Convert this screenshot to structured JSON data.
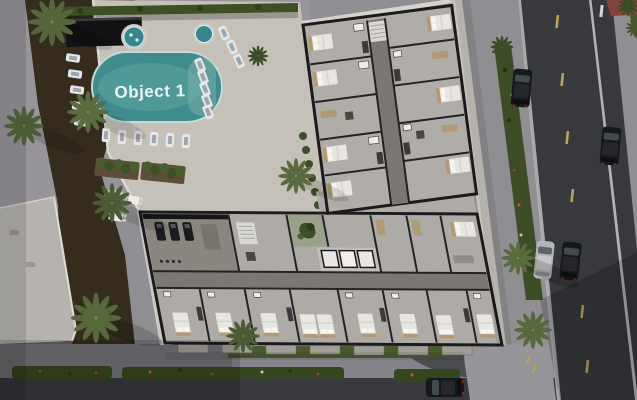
{
  "scene": {
    "title": "Aerial 3D cutaway render of a residential complex",
    "view": "top-down dollhouse view showing furnished apartment floor plans, rooftop pool amenity deck, palm landscaping and surrounding streets"
  },
  "pool": {
    "brand_label": "Object 1",
    "water_color": "#3f8b8e",
    "label_color": "#e9f5f3"
  },
  "site": {
    "amenities": [
      "swimming pool",
      "jacuzzi",
      "sun loungers",
      "pergola cabana",
      "outdoor dining",
      "gym",
      "interior garden courtyard",
      "lit elevator bank"
    ],
    "surroundings": [
      "palm trees",
      "flower hedges",
      "east street with cars",
      "south street",
      "red paver crosswalk",
      "adjacent building roof"
    ]
  },
  "counts": {
    "cars_visible": 5,
    "jacuzzis": 2,
    "lit_elevators": 3
  },
  "palette": {
    "deck": "#c6c1b8",
    "building_floor": "#aeaaa5",
    "interior_walls": "#232226",
    "corridor": "#7b7874",
    "road_asphalt": "#37393d",
    "sidewalk": "#8f8e92",
    "hedge_green": "#36461f",
    "palm_green": "#55663c",
    "mulch_brown": "#352c1e",
    "lawn_green": "#4a5a2d",
    "adjacent_roof": "#b6b3ae",
    "crosswalk_red": "#80443a",
    "lane_yellow": "#b7a455",
    "car_dark": "#17181b",
    "car_silver": "#b4b5b8"
  }
}
